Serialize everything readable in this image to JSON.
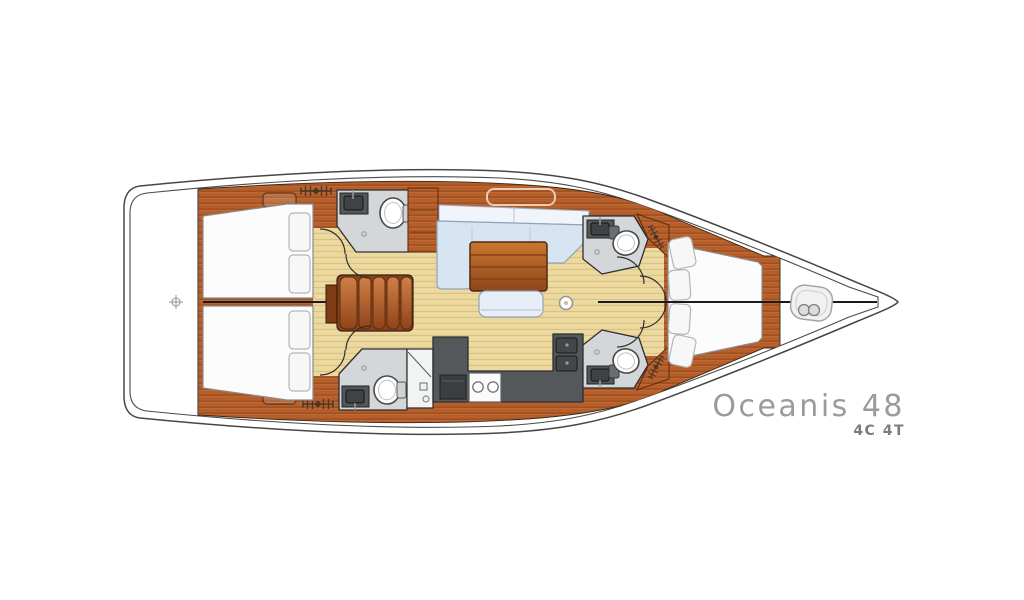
{
  "title": {
    "model": "Oceanis 48",
    "layout_code": "4C 4T"
  },
  "colors": {
    "background": "#ffffff",
    "hull_line": "#4a4a4a",
    "wood_deck": "#b45f2c",
    "wood_dark": "#8a421a",
    "floor_tan": "#ecd9a0",
    "upholstery_blue": "#d7e5f3",
    "cushion_white": "#eff5fb",
    "head_floor_gray": "#d4d7d9",
    "counter_dark_gray": "#54585b",
    "mattress_white": "#fcfcfc",
    "label_gray": "#9b9b9b",
    "sublabel_gray": "#7d7d7d"
  },
  "icons": {
    "windlass": "windlass-icon",
    "deck_vent": "deck-vent-icon",
    "transom_marker": "crosshair-icon",
    "shower_drain": "shower-drain-icon"
  }
}
